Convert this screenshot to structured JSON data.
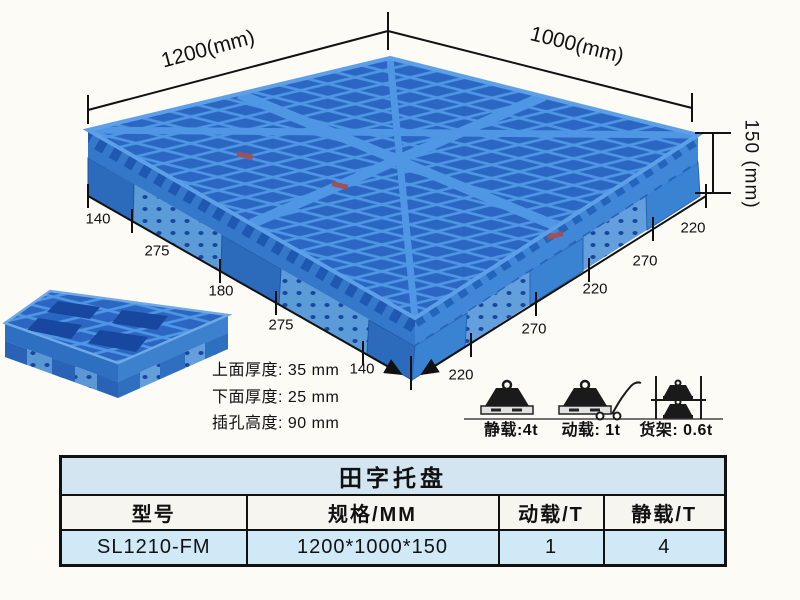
{
  "annotations": {
    "top_width": "1200(mm)",
    "top_depth": "1000(mm)",
    "side_height": "150 (mm)",
    "left_edge_dims": [
      "140",
      "275",
      "180",
      "275",
      "140"
    ],
    "right_edge_dims": [
      "220",
      "270",
      "220",
      "270",
      "220"
    ],
    "thickness_notes": [
      "上面厚度: 35 mm",
      "下面厚度: 25 mm",
      "插孔高度: 90 mm"
    ],
    "load_labels": [
      "静载:4t",
      "动载: 1t",
      "货架: 0.6t"
    ]
  },
  "table": {
    "title": "田字托盘",
    "columns": [
      "型号",
      "规格/MM",
      "动载/T",
      "静载/T"
    ],
    "rows": [
      [
        "SL1210-FM",
        "1200*1000*150",
        "1",
        "4"
      ]
    ]
  },
  "colors": {
    "pallet_rib_blue": "#4f97e4",
    "pallet_dark_blue": "#1c55b0",
    "pallet_side_blue": "#3a7fd0",
    "table_title_blue": "#d2e5f0",
    "table_row_blue": "#cfe9f6",
    "background": "#fcfbf5",
    "line_black": "#111111"
  }
}
